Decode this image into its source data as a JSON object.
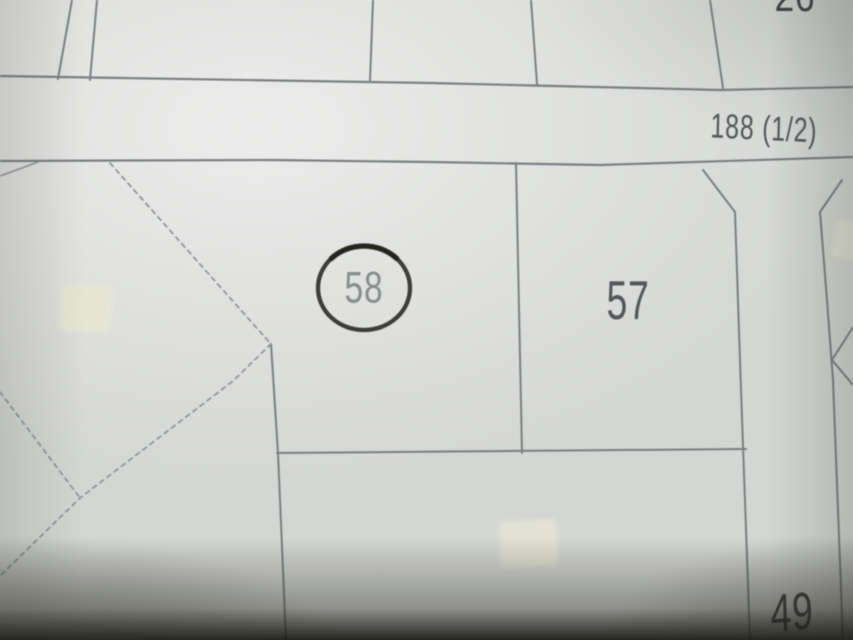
{
  "colors": {
    "paper": "#d4d6d3",
    "paper_light": "#e7e8e6",
    "paper_shade": "#c2c5c2",
    "line": "#7a7f83",
    "dash": "#8e9396",
    "ink_dark": "#3a3c40",
    "ink_mid": "#54575b",
    "ink_soft": "#8a8d90",
    "marker": "#32312b",
    "marker_dark": "#1f1e17",
    "sticker": "#e7e7d3",
    "shadow": "#21221b"
  },
  "map": {
    "road_label": "188 (1/2)",
    "parcels": [
      {
        "number": "58",
        "annotation": "hand-drawn-circle"
      },
      {
        "number": "57"
      },
      {
        "number": "49"
      }
    ],
    "top_edge_partial_label": "26"
  }
}
